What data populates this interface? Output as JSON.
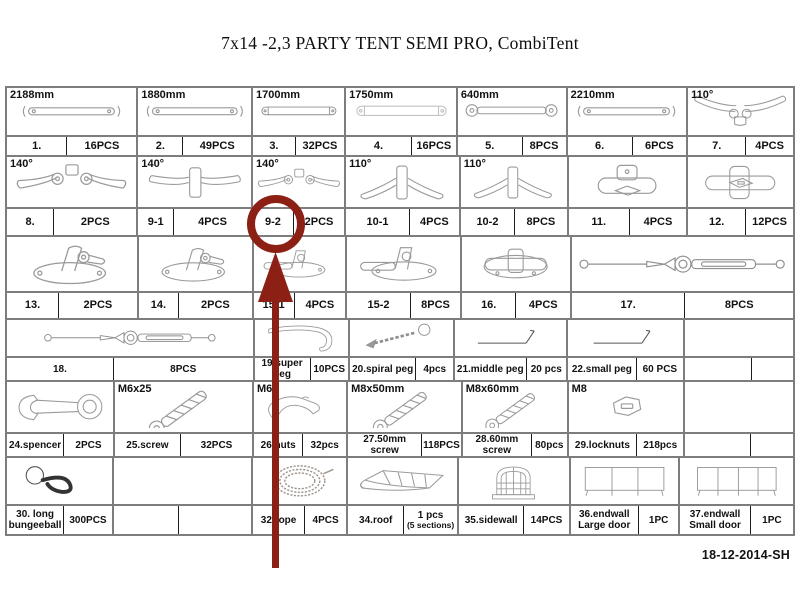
{
  "title": "7x14 -2,3 PARTY TENT SEMI PRO, CombiTent",
  "footer": {
    "date_code": "18-12-2014-SH"
  },
  "annotation": {
    "target_part": "9-2",
    "color": "#8c2014"
  },
  "table": {
    "bands": [
      {
        "cells": [
          {
            "dim": "2188mm",
            "num": "1.",
            "qty": "16PCS",
            "icon": "pole-bar"
          },
          {
            "dim": "1880mm",
            "num": "2.",
            "qty": "49PCS",
            "icon": "pole-bar"
          },
          {
            "dim": "1700mm",
            "num": "3.",
            "qty": "32PCS",
            "icon": "pole-bar-bracket"
          },
          {
            "dim": "1750mm",
            "num": "4.",
            "qty": "16PCS",
            "icon": "pole-bar-bracket"
          },
          {
            "dim": "640mm",
            "num": "5.",
            "qty": "8PCS",
            "icon": "short-link"
          },
          {
            "dim": "2210mm",
            "num": "6.",
            "qty": "6PCS",
            "icon": "pole-bar"
          },
          {
            "dim": "110°",
            "num": "7.",
            "qty": "4PCS",
            "icon": "corner-3way"
          }
        ]
      },
      {
        "cells": [
          {
            "dim": "140°",
            "num": "8.",
            "qty": "2PCS",
            "icon": "ridge-fitting"
          },
          {
            "dim": "140°",
            "num": "9-1",
            "qty": "4PCS",
            "icon": "ridge-tee-fitting"
          },
          {
            "dim": "140°",
            "num": "9-2",
            "qty": "2PCS",
            "icon": "ridge-fitting",
            "highlighted": true
          },
          {
            "dim": "110°",
            "num": "10-1",
            "qty": "4PCS",
            "icon": "angle-tee-fitting"
          },
          {
            "dim": "110°",
            "num": "10-2",
            "qty": "8PCS",
            "icon": "angle-tee-fitting"
          },
          {
            "dim": "",
            "num": "11.",
            "qty": "4PCS",
            "icon": "tee-fitting"
          },
          {
            "dim": "",
            "num": "12.",
            "qty": "12PCS",
            "icon": "cross-fitting"
          }
        ]
      },
      {
        "cells": [
          {
            "num": "13.",
            "qty": "2PCS",
            "icon": "foot-plate"
          },
          {
            "num": "14.",
            "qty": "2PCS",
            "icon": "foot-plate"
          },
          {
            "num": "15-1",
            "qty": "4PCS",
            "icon": "foot-plate-side"
          },
          {
            "num": "15-2",
            "qty": "8PCS",
            "icon": "foot-plate-side"
          },
          {
            "num": "16.",
            "qty": "4PCS",
            "icon": "foot-plate-tee"
          },
          {
            "num": "17.",
            "qty": "8PCS",
            "icon": "guy-wire"
          }
        ]
      },
      {
        "cells": [
          {
            "num": "18.",
            "qty": "8PCS",
            "icon": "guy-wire"
          },
          {
            "num": "19.super peg",
            "qty": "10PCS",
            "icon": "super-peg"
          },
          {
            "num": "20.spiral peg",
            "qty": "4pcs",
            "icon": "spiral-peg"
          },
          {
            "num": "21.middle peg",
            "qty": "20 pcs",
            "icon": "peg"
          },
          {
            "num": "22.small peg",
            "qty": "60 PCS",
            "icon": "peg"
          },
          {
            "num": "",
            "qty": "",
            "icon": ""
          }
        ]
      },
      {
        "cells": [
          {
            "dim": "",
            "num": "24.spencer",
            "qty": "2PCS",
            "icon": "wrench"
          },
          {
            "dim": "M6x25",
            "num": "25.screw",
            "qty": "32PCS",
            "icon": "screw"
          },
          {
            "dim": "M6",
            "num": "26.nuts",
            "qty": "32pcs",
            "icon": "hook-clip"
          },
          {
            "dim": "M8x50mm",
            "num": "27.50mm screw",
            "qty": "118PCS",
            "icon": "screw"
          },
          {
            "dim": "M8x60mm",
            "num": "28.60mm screw",
            "qty": "80pcs",
            "icon": "screw"
          },
          {
            "dim": "M8",
            "num": "29.locknuts",
            "qty": "218pcs",
            "icon": "locknut"
          },
          {
            "dim": "",
            "num": "",
            "qty": "",
            "icon": ""
          }
        ]
      },
      {
        "cells": [
          {
            "num": "30. long bungeeball",
            "qty": "300PCS",
            "icon": "bungee-ball"
          },
          {
            "num": "",
            "qty": "",
            "icon": ""
          },
          {
            "num": "32.rope",
            "qty": "4PCS",
            "icon": "rope-coil"
          },
          {
            "num": "34.roof",
            "qty": "1 pcs",
            "qty2": "(5 sections)",
            "icon": "roof"
          },
          {
            "num": "35.sidewall",
            "qty": "14PCS",
            "icon": "sidewall"
          },
          {
            "num": "36.endwall Large door",
            "qty": "1PC",
            "icon": "endwall-large-door"
          },
          {
            "num": "37.endwall Small door",
            "qty": "1PC",
            "icon": "endwall-small-door"
          }
        ]
      }
    ]
  }
}
